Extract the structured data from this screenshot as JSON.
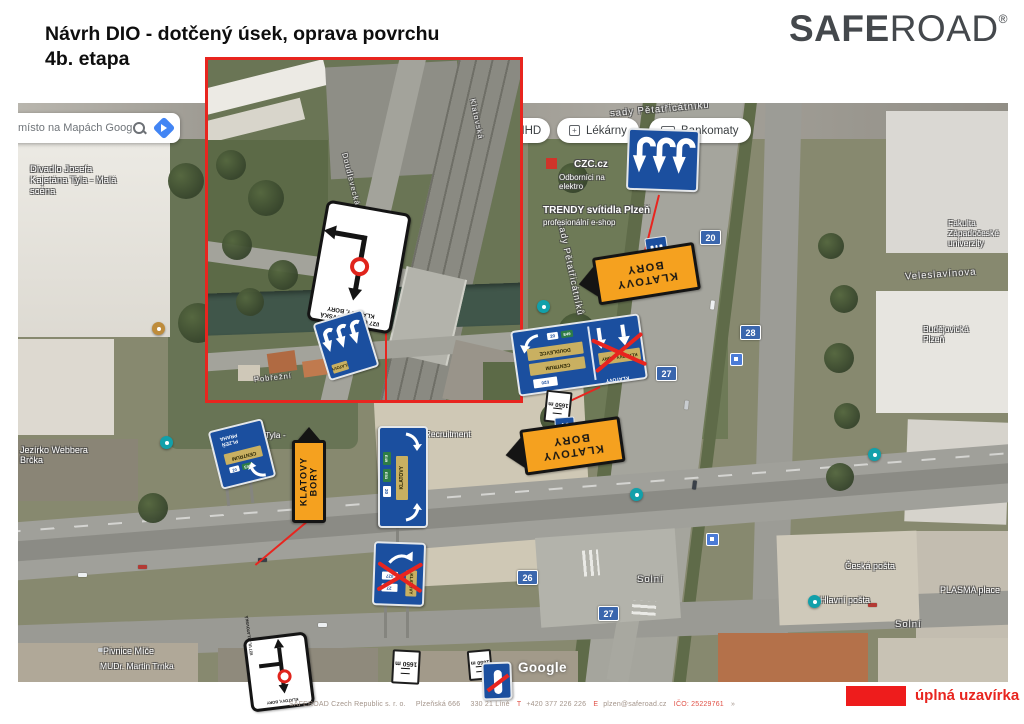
{
  "colors": {
    "accent_red": "#e8251f",
    "legend_red": "#ee1c1c",
    "sign_orange": "#f5a11f",
    "sign_blue": "#1b4f9f",
    "google_blue": "#4285f4"
  },
  "header": {
    "title_line1": "Návrh DIO - dotčený úsek, oprava povrchu",
    "title_line2": "4b. etapa"
  },
  "logo": {
    "bold": "SAFE",
    "light": "ROAD",
    "reg": "®"
  },
  "google_ui": {
    "search_text": "místo na Mapách Google",
    "chips": [
      {
        "label": "MHD"
      },
      {
        "label": "Lékárny"
      },
      {
        "label": "Bankomaty"
      }
    ],
    "watermark": "Google"
  },
  "legend": {
    "label": "úplná uzavírka"
  },
  "footer": {
    "company": "SAFEROAD Czech Republic s. r. o.",
    "street": "Plzeňská 666",
    "city": "330 21 Líně",
    "phone_prefix": "T",
    "phone": "+420 377 226 226",
    "email_prefix": "E",
    "email": "plzen@saferoad.cz",
    "ico": "IČO: 25229761",
    "chevron": "»"
  },
  "signs": {
    "detour_arrow": {
      "line1": "KLATOVY",
      "line2": "BORY"
    },
    "closure": {
      "line1": "I/27 UL. KLATOVSKÁ",
      "line2": "KLATOVY, BORY"
    },
    "distance": {
      "text": "1650 m"
    },
    "overhead": {
      "dest1": "DOUDLEVCE",
      "dest2": "CENTRUM",
      "dest3": "KLATOVY, BORY",
      "corner": "KLATOVY",
      "shield": "20",
      "eshield": "E49",
      "small_box": "I/20"
    },
    "gantry_left": {
      "line1": "PRAHA",
      "line2": "PLZEŇ",
      "dest": "CENTRUM",
      "shield": "20",
      "eshield": "E49"
    },
    "vertical_panel": {
      "dest": "KLATOVY",
      "e1": "E49",
      "e2": "E53",
      "shield": "20"
    },
    "crossed_exit": {
      "dest": "KLATOVY",
      "box1": "I/27",
      "box2": "27"
    }
  },
  "map_labels": {
    "theater1": "Divadlo Josefa Kajetána Tyla - Malá scéna",
    "theater2": "Divadlo J. K. Tyla - Nová scéna",
    "webbera": "Jezírko Webbera Brčka",
    "pivnice": "Pivnice Míče",
    "trnka": "MUDr. Martin Trnka",
    "sady": "sady Pětatřicátníků",
    "veleslavinova": "Veleslavínova",
    "fakulta": "Fakulta Západočeské univerzity",
    "budejovicka": "Budějovická Plzeň",
    "solni": "Solní",
    "hlavni_posta": "Hlavní pošta",
    "ceska_posta": "Česká pošta",
    "plasma": "PLASMA place",
    "trendy": "TRENDY svítidla Plzeň",
    "trendy_sub": "profesionální e-shop",
    "czc": "CZC.cz",
    "czc_sub": "Odborníci na elektro",
    "triangle": "Triangle Recruitment s.r.o.",
    "klatovska": "Klatovská",
    "pobrezni": "Pobřežní",
    "doudlevecka": "Doudlevecká",
    "r20": "20",
    "r26": "26",
    "r27": "27",
    "r28": "28"
  }
}
